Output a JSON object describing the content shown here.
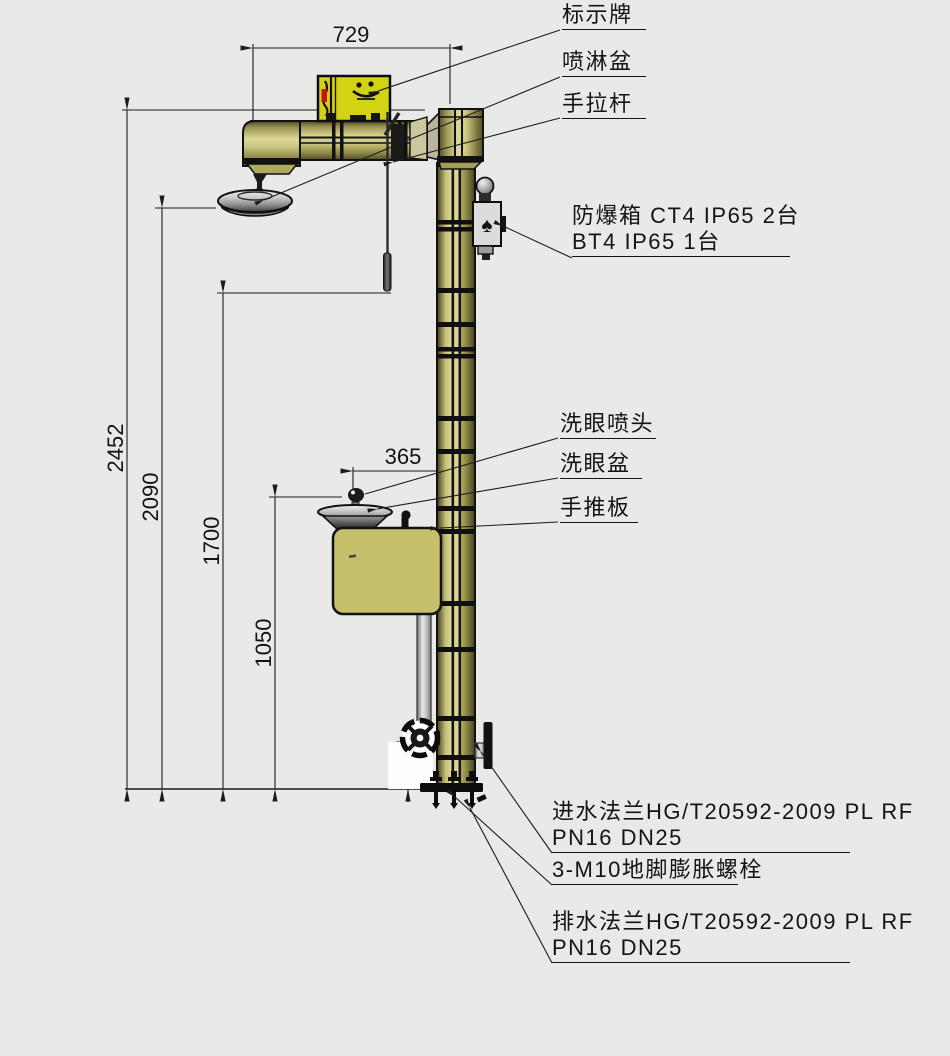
{
  "drawing_type": "emergency shower and eyewash station installation drawing",
  "labels": {
    "sign_plate": "标示牌",
    "shower_basin": "喷淋盆",
    "pull_rod": "手拉杆",
    "explosion_box_line1": "防爆箱 CT4 IP65 2台",
    "explosion_box_line2": "BT4 IP65 1台",
    "eyewash_nozzle": "洗眼喷头",
    "eyewash_basin": "洗眼盆",
    "push_plate": "手推板",
    "inlet_flange_line1": "进水法兰HG/T20592-2009 PL RF",
    "inlet_flange_line2": "PN16 DN25",
    "anchor_bolt": "3-M10地脚膨胀螺栓",
    "drain_flange_line1": "排水法兰HG/T20592-2009 PL RF",
    "drain_flange_line2": "PN16 DN25"
  },
  "dimensions": {
    "arm_span": "729",
    "total_height": "2452",
    "shower_head_height": "2090",
    "pull_rod_height": "1700",
    "eyewash_height": "1050",
    "eyewash_offset": "365",
    "inlet_flange_height": "135"
  },
  "icons": {
    "spade": "♠"
  },
  "colors": {
    "background": "#e9e9e7",
    "body_olive": "#c9c47c",
    "sign_yellow": "#d3d314",
    "metal_gray": "#dcdcdc",
    "red_mark": "#cc1111",
    "line": "#1c1c1c"
  }
}
